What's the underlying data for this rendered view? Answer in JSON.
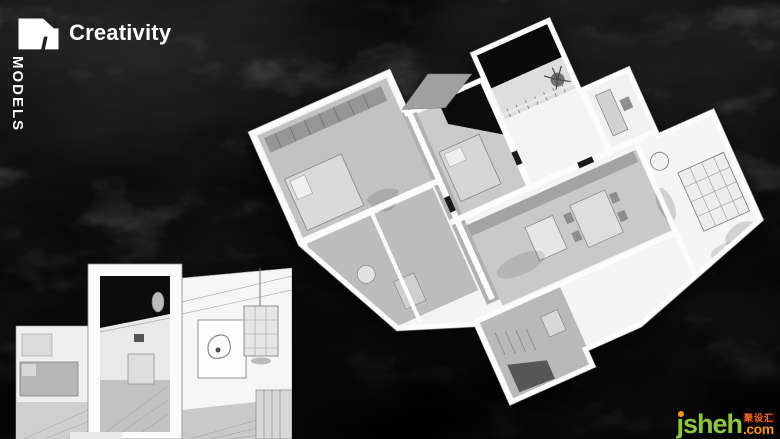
{
  "slide": {
    "title": "Creativity",
    "side_label": "MODELS"
  },
  "watermark": {
    "brand": "jsheh",
    "cjk_badge": "聚设汇",
    "tld": ".com",
    "brand_color": "#8dc63f",
    "accent_color": "#f7941d"
  },
  "scene": {
    "background_color": "#1b1b1b",
    "text_color": "#ffffff",
    "model_wall_color": "#fafafa",
    "model_floor_color": "#c6c6c6",
    "model_opening_color": "#0a0a0a",
    "logo_icon": "dune-logo-icon",
    "main_image": "axonometric-apartment-3d-model",
    "detail_image": "interior-cutaway-detail-views"
  }
}
